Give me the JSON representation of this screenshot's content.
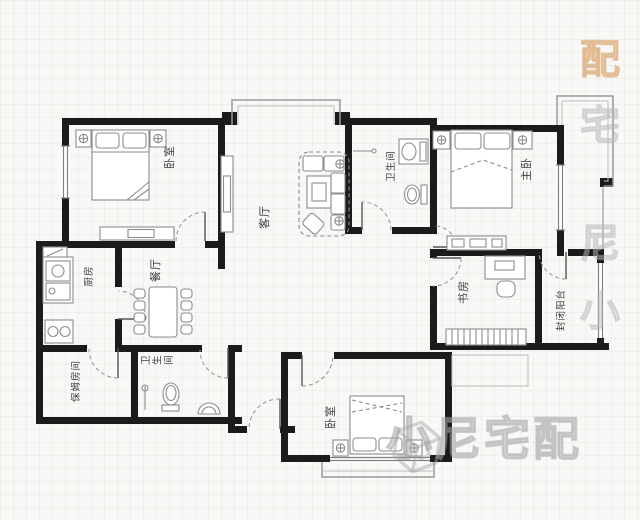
{
  "rooms": [
    {
      "id": "bedroom-top-left",
      "label": "卧室"
    },
    {
      "id": "living-room",
      "label": "客厅"
    },
    {
      "id": "bathroom-main",
      "label": "卫生间"
    },
    {
      "id": "master-bedroom",
      "label": "主卧"
    },
    {
      "id": "study",
      "label": "书房"
    },
    {
      "id": "enclosed-balcony",
      "label": "封闭阳台"
    },
    {
      "id": "dining-room",
      "label": "餐厅"
    },
    {
      "id": "kitchen",
      "label": "厨房"
    },
    {
      "id": "maid-room",
      "label": "保姆房间"
    },
    {
      "id": "bathroom-second",
      "label": "卫生间"
    },
    {
      "id": "bedroom-bottom",
      "label": "卧室"
    }
  ],
  "watermark": {
    "brand": "小尼宅配",
    "vertical_chars": [
      "配",
      "宅",
      "尼",
      "小"
    ],
    "logo": "cube-logo"
  },
  "colors": {
    "wall": "#1b1b1b",
    "furniture_line": "#8d8d8d",
    "label_text": "#3c3c3c",
    "watermark_gray": "#bdbdbd",
    "watermark_orange": "#e3b282",
    "background": "#f8f8f6"
  }
}
